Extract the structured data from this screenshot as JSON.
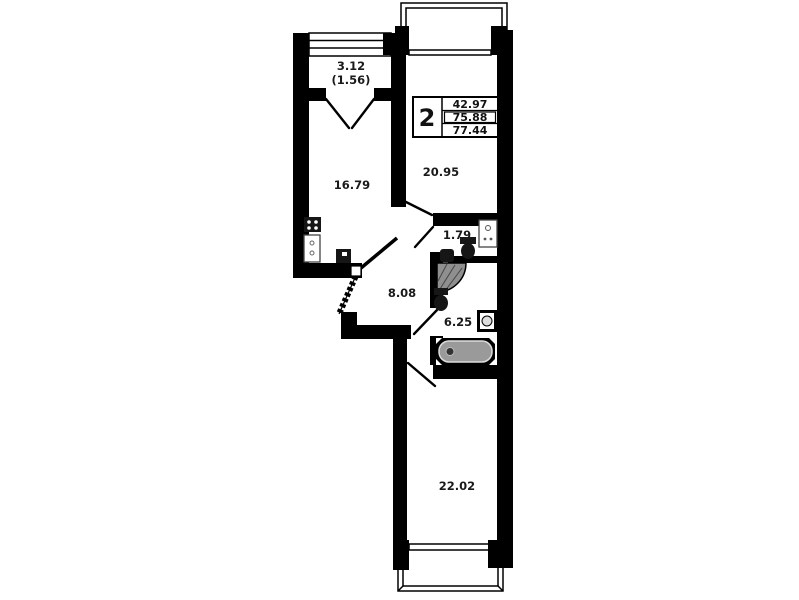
{
  "plan": {
    "rooms": {
      "balcony": "3.12",
      "balcony_reduced": "(1.56)",
      "kitchen": "16.79",
      "living_room": "20.95",
      "wc": "1.79",
      "hallway": "8.08",
      "bathroom": "6.25",
      "bedroom": "22.02"
    },
    "legend": {
      "room_count": "2",
      "area_living": "42.97",
      "area_total": "75.88",
      "area_total_with_balcony": "77.44"
    },
    "colors": {
      "wall": "#000000",
      "background": "#ffffff",
      "fixture_gray": "#9a9a9a"
    }
  }
}
